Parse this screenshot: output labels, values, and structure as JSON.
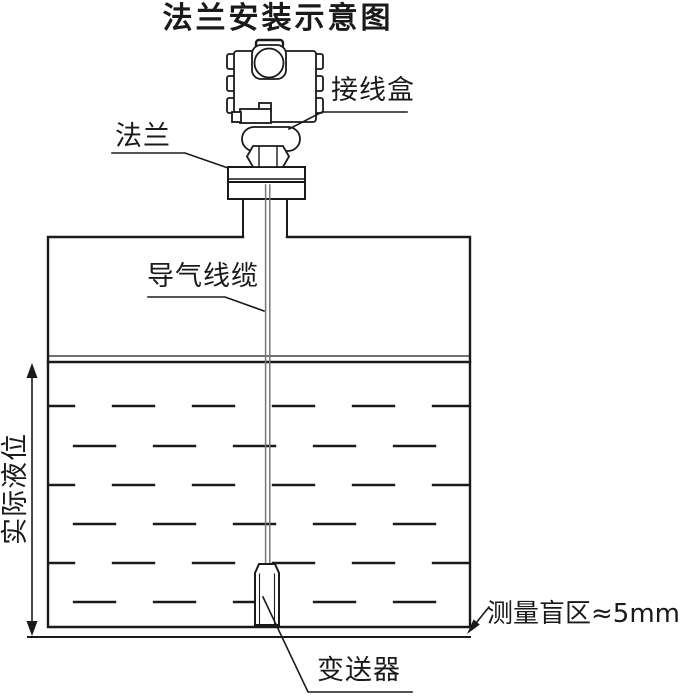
{
  "title": "法兰安装示意图",
  "labels": {
    "junction_box": "接线盒",
    "flange": "法兰",
    "air_cable": "导气线缆",
    "actual_level": "实际液位",
    "blind_zone": "测量盲区≈5mm",
    "transmitter": "变送器"
  },
  "colors": {
    "line": "#1a1a1a",
    "cable": "#777777",
    "background": "#ffffff"
  }
}
